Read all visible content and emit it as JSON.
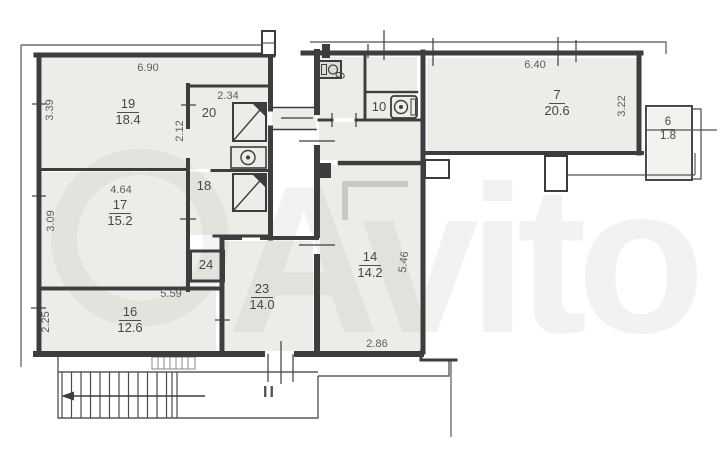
{
  "title": "apartment-floor-plan",
  "watermark": {
    "text": "Avito"
  },
  "plan": {
    "section_mark": "II",
    "rooms": {
      "r19": {
        "number": "19",
        "area": "18.4"
      },
      "r20": {
        "number": "20"
      },
      "r18": {
        "number": "18"
      },
      "r24": {
        "number": "24"
      },
      "r17": {
        "number": "17",
        "area": "15.2"
      },
      "r16": {
        "number": "16",
        "area": "12.6"
      },
      "r23": {
        "number": "23",
        "area": "14.0"
      },
      "r14": {
        "number": "14",
        "area": "14.2"
      },
      "r9": {
        "number": "9"
      },
      "r10": {
        "number": "10"
      },
      "r7": {
        "number": "7",
        "area": "20.6"
      },
      "r6": {
        "number": "6",
        "area": "1.8"
      }
    },
    "dimensions": {
      "room19_width": "6.90",
      "room19_depth": "3.39",
      "room20_width": "2.34",
      "room20_depth": "2.12",
      "room17_width": "4.64",
      "room17_depth": "3.09",
      "room16_width": "5.59",
      "room16_depth": "2.25",
      "room14_depth": "5.46",
      "room14_width": "2.86",
      "room7_width": "6.40",
      "room7_depth": "3.22"
    },
    "icons": {
      "shower_room20": "shower-tray-icon",
      "sink_room20": "sink-icon",
      "shower_room18": "shower-tray-icon",
      "sink_room9": "sink-icon",
      "washer_room10": "washing-machine-icon",
      "stairs": "staircase-hatch",
      "arrow": "stair-direction-arrow"
    },
    "colors": {
      "wall": "#3d3d3d",
      "room_fill": "#edece8",
      "dim_text": "#5d5d5d",
      "label_text": "#474747",
      "watermark": "#8c8a80",
      "background": "#ffffff"
    }
  }
}
